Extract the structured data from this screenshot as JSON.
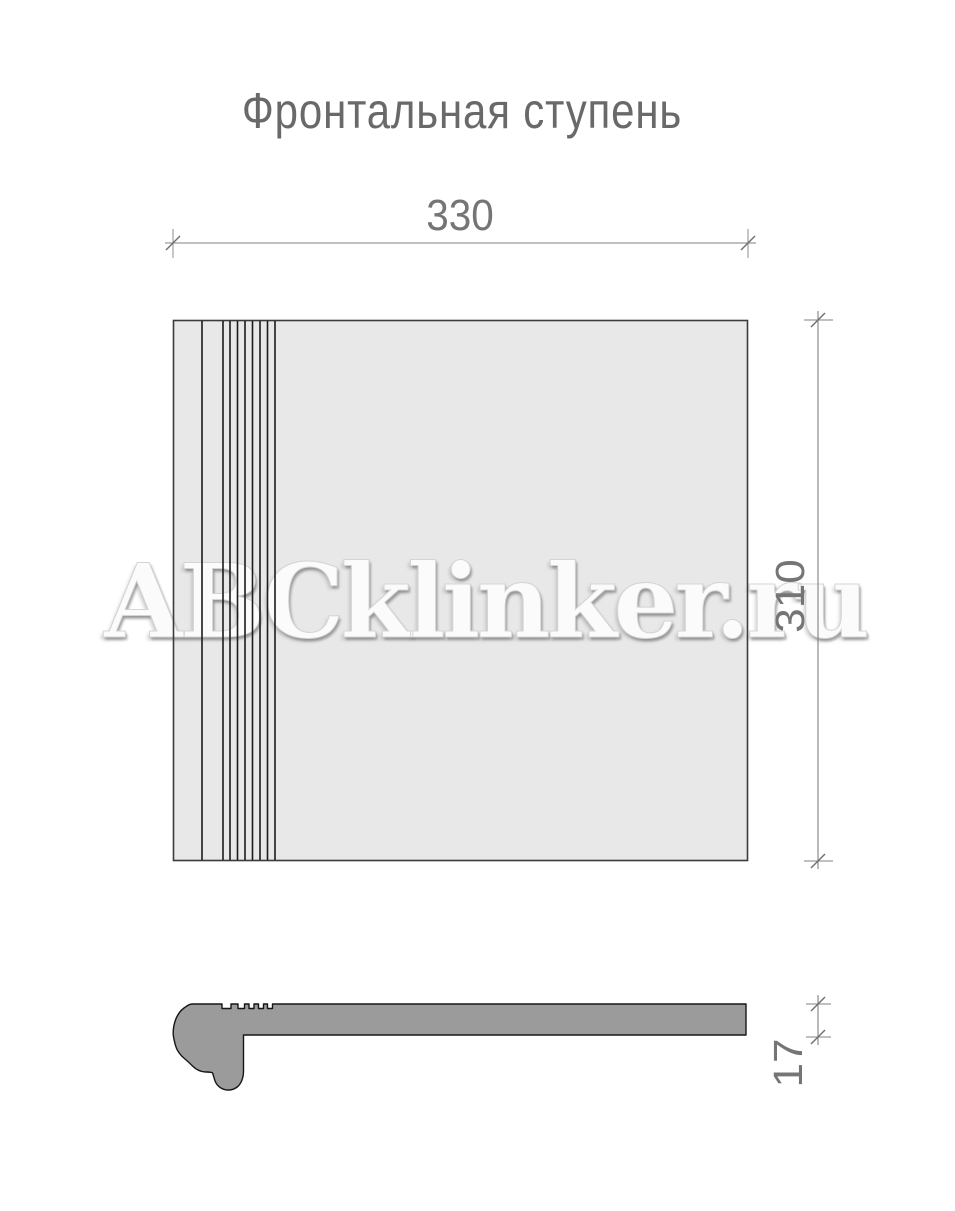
{
  "title": "Фронтальная ступень",
  "watermark": "ABCklinker.ru",
  "dimensions": {
    "width": {
      "value": "330",
      "orientation": "horizontal",
      "applies_to": "plan-view"
    },
    "depth": {
      "value": "310",
      "orientation": "vertical",
      "applies_to": "plan-view"
    },
    "thickness": {
      "value": "17",
      "orientation": "vertical",
      "applies_to": "profile-view"
    }
  },
  "colors": {
    "background": "#ffffff",
    "tile_fill": "#e8e8e8",
    "profile_fill": "#9b9b9b",
    "groove_line": "#1c1c1c",
    "dimension_line": "#828282",
    "text": "#757575",
    "title_text": "#696969"
  }
}
